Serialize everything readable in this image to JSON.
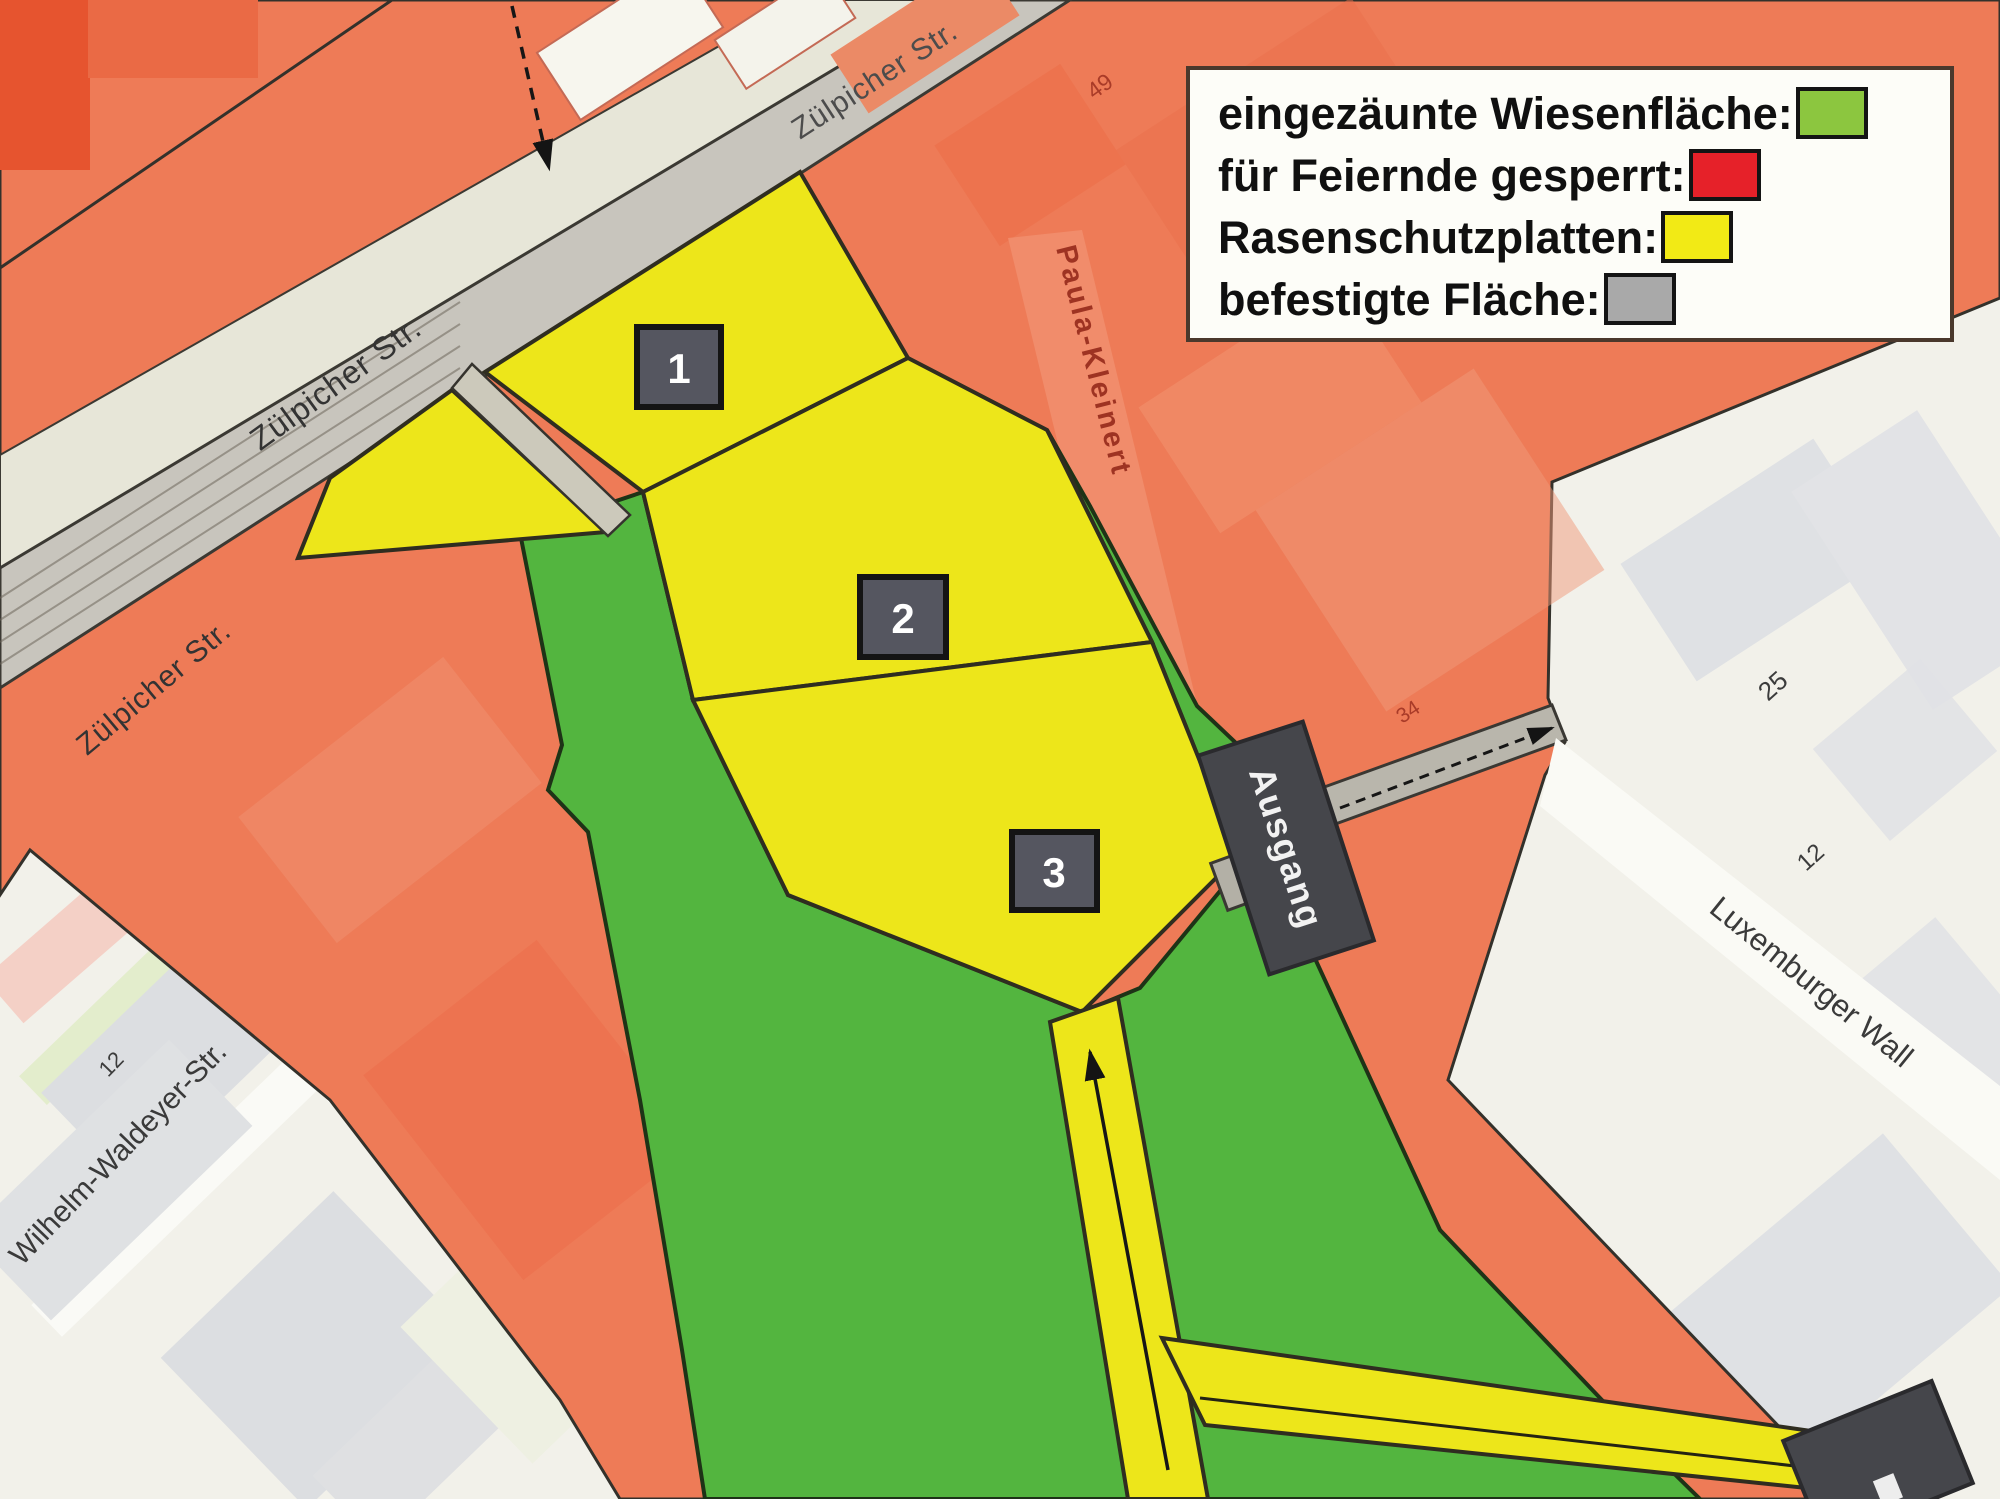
{
  "legend": {
    "items": [
      {
        "label": "eingezäunte Wiesenfläche:",
        "color": "#8cc63f"
      },
      {
        "label": "für Feiernde gesperrt:",
        "color": "#e62129"
      },
      {
        "label": "Rasenschutzplatten:",
        "color": "#f2ea15"
      },
      {
        "label": "befestigte Fläche:",
        "color": "#a9a9a9"
      }
    ]
  },
  "map": {
    "streets": {
      "zuelpicher_top": "Zülpicher Str.",
      "zuelpicher_mid": "Zülpicher Str.",
      "zuelpicher_low": "Zülpicher Str.",
      "wilhelm": "Wilhelm-Waldeyer-Str.",
      "luxemburger": "Luxemburger Wall",
      "paula": "Paula-Kleinert"
    },
    "markers": [
      {
        "label": "1"
      },
      {
        "label": "2"
      },
      {
        "label": "3"
      }
    ],
    "signs": {
      "exit": "Ausgang"
    },
    "house_numbers": {
      "h49": "49",
      "h34": "34",
      "h25": "25",
      "h12_right": "12",
      "h12_left": "12"
    },
    "colors": {
      "meadow_green": "#53b53f",
      "closed_red": "#ee7b57",
      "plates_yellow": "#ede61a",
      "paved_gray": "#c8c5bd"
    }
  }
}
